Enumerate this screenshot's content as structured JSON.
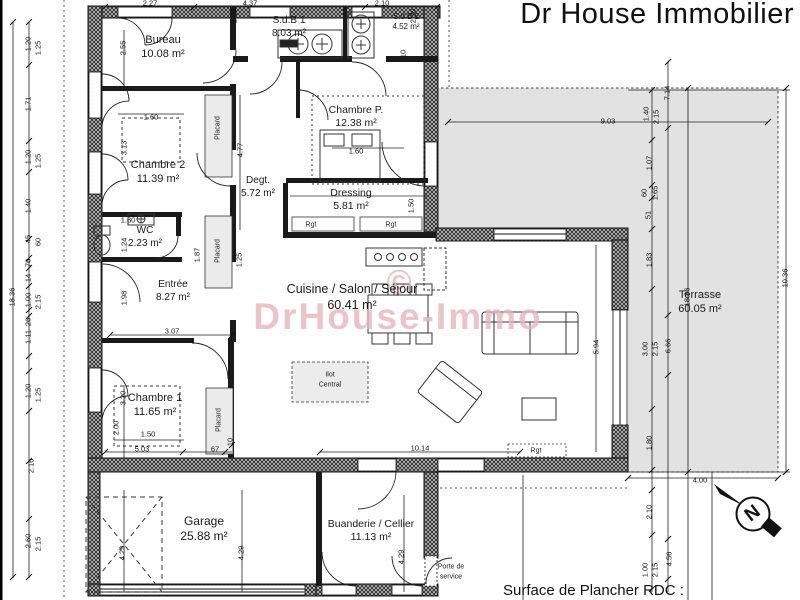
{
  "title": "Dr House Immobilier",
  "watermark": {
    "symbol": "©",
    "text": "DrHouse-Immo",
    "color": "#e4b6c0"
  },
  "footer": {
    "surface_label": "Surface de Plancher RDC :"
  },
  "compass": {
    "letter": "N"
  },
  "colors": {
    "paper": "#ffffff",
    "ink": "#1a1a1a",
    "terrace_fill": "#e2e2e2",
    "placard_fill": "#ebebeb",
    "island_fill": "#ececec",
    "watermark_pink": "#e4b6c0"
  },
  "rooms": [
    {
      "name": "Bureau",
      "area": "10.08 m²",
      "x": 163,
      "y": 34,
      "fs": 11
    },
    {
      "name": "S.d.B 1",
      "area": "8.03 m²",
      "x": 289,
      "y": 15,
      "fs": 10
    },
    {
      "name": "S.d.B 2",
      "area": "4.52 m²",
      "x": 406,
      "y": 12,
      "fs": 8
    },
    {
      "name": "Chambre P.",
      "area": "12.38 m²",
      "x": 356,
      "y": 104,
      "fs": 10.5
    },
    {
      "name": "Chambre 2",
      "area": "11.39 m²",
      "x": 158,
      "y": 159,
      "fs": 11
    },
    {
      "name": "Degt.",
      "area": "5.72 m²",
      "x": 258,
      "y": 175,
      "fs": 10
    },
    {
      "name": "Dressing",
      "area": "5.81 m²",
      "x": 351,
      "y": 187,
      "fs": 10.5
    },
    {
      "name": "WC",
      "area": "2.23 m²",
      "x": 145,
      "y": 225,
      "fs": 10
    },
    {
      "name": "Entrée",
      "area": "8.27 m²",
      "x": 173,
      "y": 279,
      "fs": 10
    },
    {
      "name": "Chambre 1",
      "area": "11.65 m²",
      "x": 155,
      "y": 392,
      "fs": 11
    },
    {
      "name": "Cuisine / Salon / Séjour",
      "area": "60.41 m²",
      "x": 352,
      "y": 282,
      "fs": 12.5
    },
    {
      "name": "Garage",
      "area": "25.88 m²",
      "x": 204,
      "y": 514,
      "fs": 12
    },
    {
      "name": "Buanderie / Cellier",
      "area": "11.13 m²",
      "x": 371,
      "y": 518,
      "fs": 10.5
    },
    {
      "name": "Terrasse",
      "area": "60.05 m²",
      "x": 700,
      "y": 289,
      "fs": 11
    }
  ],
  "small_labels": [
    {
      "t": "Placard",
      "x": 218,
      "y": 128,
      "r": 1
    },
    {
      "t": "Placard",
      "x": 218,
      "y": 251,
      "r": 1
    },
    {
      "t": "Placard",
      "x": 219,
      "y": 420,
      "r": 1
    },
    {
      "t": "Rgt",
      "x": 311,
      "y": 225,
      "r": 0
    },
    {
      "t": "Rgt",
      "x": 391,
      "y": 225,
      "r": 0
    },
    {
      "t": "Rgt",
      "x": 536,
      "y": 451,
      "r": 0
    },
    {
      "t": "Ilot",
      "x": 330,
      "y": 375,
      "r": 0
    },
    {
      "t": "Central",
      "x": 330,
      "y": 385,
      "r": 0
    },
    {
      "t": "Porte de",
      "x": 451,
      "y": 567,
      "r": 0
    },
    {
      "t": "service",
      "x": 451,
      "y": 577,
      "r": 0
    }
  ],
  "dimensions": [
    {
      "t": "2.27",
      "x": 150,
      "y": 3,
      "r": 0
    },
    {
      "t": "4.37",
      "x": 250,
      "y": 3,
      "r": 0
    },
    {
      "t": "2.10",
      "x": 382,
      "y": 3,
      "r": 0
    },
    {
      "t": "2.20",
      "x": 234,
      "y": 16,
      "r": 1
    },
    {
      "t": "2.20",
      "x": 413,
      "y": 16,
      "r": 1
    },
    {
      "t": "2.55",
      "x": 123,
      "y": 48,
      "r": 1
    },
    {
      "t": "10",
      "x": 403,
      "y": 54,
      "r": 1
    },
    {
      "t": "1.20",
      "x": 28,
      "y": 44,
      "r": 1
    },
    {
      "t": "1.25",
      "x": 38,
      "y": 48,
      "r": 1
    },
    {
      "t": "1.71",
      "x": 28,
      "y": 104,
      "r": 1
    },
    {
      "t": "1.20",
      "x": 28,
      "y": 157,
      "r": 1
    },
    {
      "t": "1.25",
      "x": 38,
      "y": 161,
      "r": 1
    },
    {
      "t": "1.40",
      "x": 28,
      "y": 206,
      "r": 1
    },
    {
      "t": "45",
      "x": 28,
      "y": 239,
      "r": 1
    },
    {
      "t": "60",
      "x": 38,
      "y": 242,
      "r": 1
    },
    {
      "t": "76",
      "x": 28,
      "y": 263,
      "r": 1
    },
    {
      "t": "14",
      "x": 28,
      "y": 278,
      "r": 1
    },
    {
      "t": "1.00",
      "x": 28,
      "y": 300,
      "r": 1
    },
    {
      "t": "2.15",
      "x": 38,
      "y": 302,
      "r": 1
    },
    {
      "t": "26",
      "x": 28,
      "y": 322,
      "r": 1
    },
    {
      "t": "1.11",
      "x": 28,
      "y": 337,
      "r": 1
    },
    {
      "t": "1.20",
      "x": 28,
      "y": 391,
      "r": 1
    },
    {
      "t": "1.25",
      "x": 38,
      "y": 395,
      "r": 1
    },
    {
      "t": "2.16",
      "x": 31,
      "y": 466,
      "r": 1
    },
    {
      "t": "2.60",
      "x": 28,
      "y": 541,
      "r": 1
    },
    {
      "t": "2.15",
      "x": 38,
      "y": 544,
      "r": 1
    },
    {
      "t": "18.36",
      "x": 12,
      "y": 297,
      "r": 1
    },
    {
      "t": "1.60",
      "x": 151,
      "y": 117,
      "r": 0
    },
    {
      "t": "3.13",
      "x": 124,
      "y": 148,
      "r": 1
    },
    {
      "t": "1.80",
      "x": 128,
      "y": 220,
      "r": 0
    },
    {
      "t": "1.24",
      "x": 124,
      "y": 245,
      "r": 1
    },
    {
      "t": "1.87",
      "x": 197,
      "y": 255,
      "r": 1
    },
    {
      "t": "1.25",
      "x": 239,
      "y": 260,
      "r": 1
    },
    {
      "t": "4.77",
      "x": 240,
      "y": 150,
      "r": 1
    },
    {
      "t": "1.98",
      "x": 124,
      "y": 298,
      "r": 1
    },
    {
      "t": "3.07",
      "x": 172,
      "y": 331,
      "r": 0
    },
    {
      "t": "3.20",
      "x": 123,
      "y": 398,
      "r": 1
    },
    {
      "t": "2.00",
      "x": 116,
      "y": 428,
      "r": 1
    },
    {
      "t": "1.50",
      "x": 148,
      "y": 434,
      "r": 0
    },
    {
      "t": "1.60",
      "x": 356,
      "y": 151,
      "r": 0
    },
    {
      "t": "1.50",
      "x": 411,
      "y": 206,
      "r": 1
    },
    {
      "t": "9.03",
      "x": 608,
      "y": 121,
      "r": 0
    },
    {
      "t": "7.14",
      "x": 667,
      "y": 93,
      "r": 1
    },
    {
      "t": "1.40",
      "x": 646,
      "y": 114,
      "r": 1
    },
    {
      "t": "2.15",
      "x": 656,
      "y": 117,
      "r": 1
    },
    {
      "t": "1.07",
      "x": 649,
      "y": 163,
      "r": 1
    },
    {
      "t": "60",
      "x": 644,
      "y": 193,
      "r": 1
    },
    {
      "t": "1.65",
      "x": 655,
      "y": 193,
      "r": 1
    },
    {
      "t": "51",
      "x": 648,
      "y": 215,
      "r": 1
    },
    {
      "t": "1.83",
      "x": 649,
      "y": 260,
      "r": 1
    },
    {
      "t": "18.36",
      "x": 687,
      "y": 297,
      "r": 1
    },
    {
      "t": "10.36",
      "x": 785,
      "y": 278,
      "r": 1
    },
    {
      "t": "3.00",
      "x": 645,
      "y": 349,
      "r": 1
    },
    {
      "t": "2.15",
      "x": 655,
      "y": 349,
      "r": 1
    },
    {
      "t": "6.66",
      "x": 668,
      "y": 346,
      "r": 1
    },
    {
      "t": "5.94",
      "x": 596,
      "y": 347,
      "r": 1
    },
    {
      "t": "10.14",
      "x": 420,
      "y": 448,
      "r": 0
    },
    {
      "t": "5.03",
      "x": 142,
      "y": 449,
      "r": 0
    },
    {
      "t": "67",
      "x": 215,
      "y": 449,
      "r": 0
    },
    {
      "t": "10",
      "x": 230,
      "y": 442,
      "r": 1
    },
    {
      "t": "1.80",
      "x": 649,
      "y": 443,
      "r": 1
    },
    {
      "t": "2.10",
      "x": 649,
      "y": 512,
      "r": 1
    },
    {
      "t": "1.00",
      "x": 645,
      "y": 570,
      "r": 1
    },
    {
      "t": "2.15",
      "x": 655,
      "y": 570,
      "r": 1
    },
    {
      "t": "4.56",
      "x": 669,
      "y": 559,
      "r": 1
    },
    {
      "t": "4.00",
      "x": 700,
      "y": 480,
      "r": 0
    },
    {
      "t": "4.29",
      "x": 122,
      "y": 553,
      "r": 1
    },
    {
      "t": "4.29",
      "x": 241,
      "y": 553,
      "r": 1
    },
    {
      "t": "4.29",
      "x": 401,
      "y": 557,
      "r": 1
    }
  ]
}
